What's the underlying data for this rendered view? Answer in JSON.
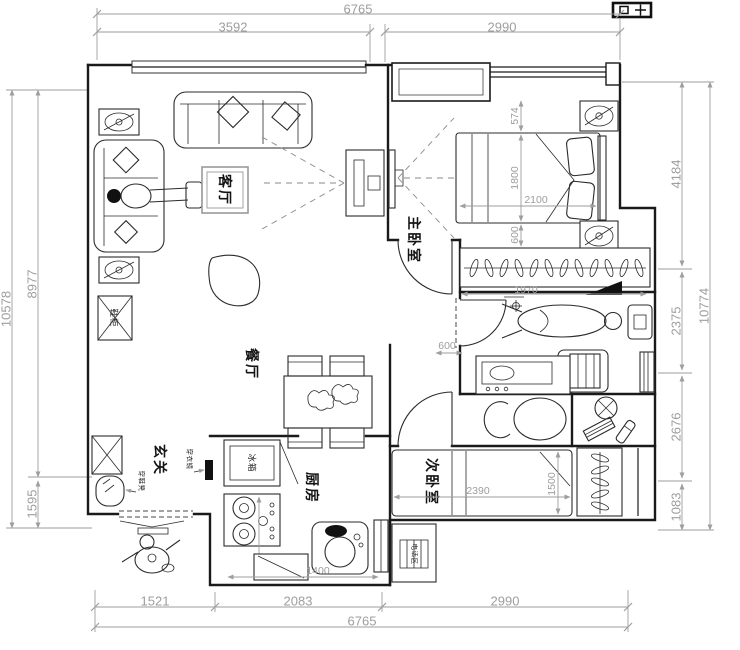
{
  "rooms": {
    "living": "客厅",
    "master_bedroom": "主卧室",
    "dining": "餐厅",
    "second_bedroom": "次卧室",
    "kitchen": "厨房",
    "entry": "玄关"
  },
  "dims": {
    "top": {
      "overall": "6765",
      "segments": [
        "3592",
        "2990"
      ]
    },
    "bottom": {
      "overall": "6765",
      "segments": [
        "1521",
        "2083",
        "2990"
      ]
    },
    "left": {
      "overall": "10578",
      "segments": [
        "8977",
        "1595"
      ]
    },
    "right": {
      "overall": "10774",
      "segments": [
        "4184",
        "2375",
        "2676",
        "1083"
      ]
    }
  },
  "interior": {
    "bed_offset_top": "574",
    "bed_width": "1800",
    "bed_length": "2100",
    "bed_offset_bottom": "600",
    "wardrobe": "1970",
    "bath_door": "600",
    "bed2_length": "2390",
    "bed2_width": "1500",
    "kitchen_run": "1400"
  },
  "labels": {
    "shoe_cabinet": "鞋柜",
    "fridge": "冰箱",
    "dressing_mirror": "穿衣镜",
    "shoe_bench": "穿鞋凳",
    "phone_area": "电话区"
  },
  "colors": {
    "wall": "#1a1a1a",
    "dimension_gray": "#9e9e9e",
    "paper": "#ffffff"
  }
}
